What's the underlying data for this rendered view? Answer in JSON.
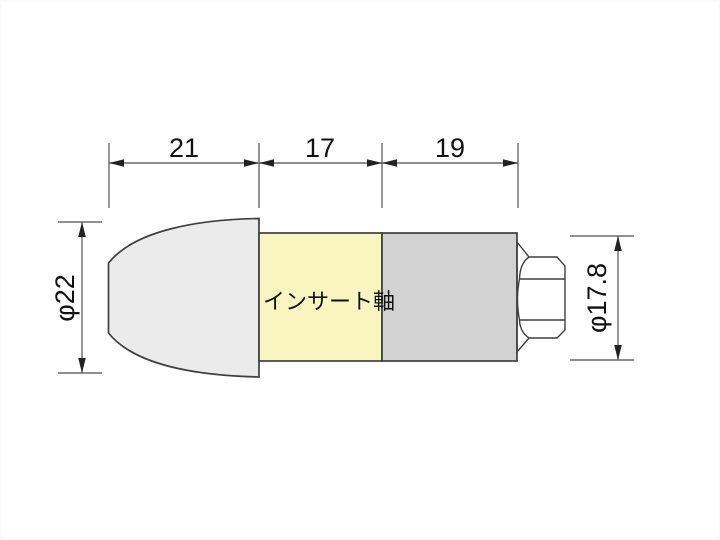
{
  "drawing": {
    "part_label": "インサート軸",
    "dimensions": {
      "top": [
        {
          "label": "21"
        },
        {
          "label": "17"
        },
        {
          "label": "19"
        }
      ],
      "left_diameter": "φ22",
      "right_diameter": "φ17.8"
    }
  },
  "colors": {
    "background": "#ffffff",
    "cap-fill": "#ebebeb",
    "shaft-fill": "#f8f5c0",
    "body-fill": "#d2d2d2",
    "nut-fill": "#ffffff",
    "outline": "#3f3f3f",
    "dim-line": "#6a6a6a",
    "arrow": "#222222",
    "text": "#111111"
  }
}
